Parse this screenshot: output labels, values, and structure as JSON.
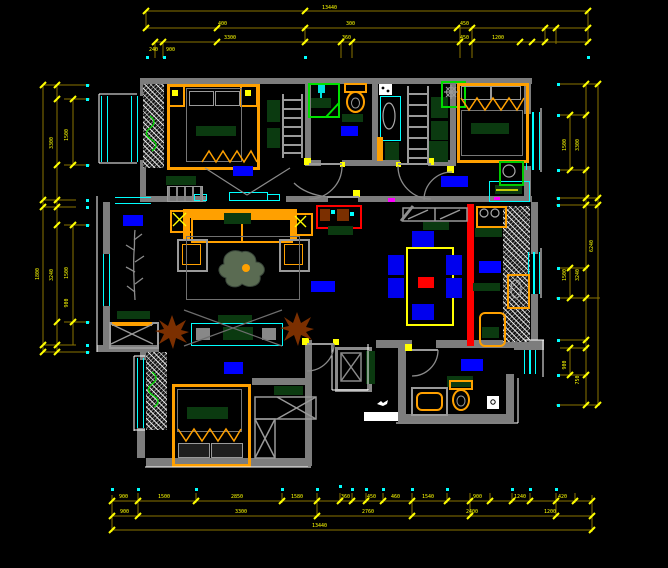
{
  "palette": {
    "background": "#000000",
    "wall_gray": "#7d7d7d",
    "window_cyan": "#00ffff",
    "dimension_line": "#8a7400",
    "dimension_text": "#ffff00",
    "furniture_orange": "#ffa000",
    "soft_green": "#0b3a10",
    "accent_red": "#ff0000",
    "plant_green": "#00dd00",
    "plant_brown": "#7b2f00",
    "label_blue": "#0000ff",
    "chair_blue": "#0000ee"
  },
  "room_labels": [
    {
      "name": "bedroom-northwest",
      "x": 233,
      "y": 166,
      "w": 20,
      "h": 10
    },
    {
      "name": "bathroom-main",
      "x": 341,
      "y": 126,
      "w": 17,
      "h": 10
    },
    {
      "name": "bedroom-northeast",
      "x": 441,
      "y": 176,
      "w": 27,
      "h": 11
    },
    {
      "name": "living-room",
      "x": 123,
      "y": 215,
      "w": 20,
      "h": 11
    },
    {
      "name": "hallway",
      "x": 311,
      "y": 281,
      "w": 24,
      "h": 11
    },
    {
      "name": "kitchen",
      "x": 479,
      "y": 261,
      "w": 22,
      "h": 12
    },
    {
      "name": "bedroom-south",
      "x": 224,
      "y": 362,
      "w": 19,
      "h": 12
    },
    {
      "name": "bathroom-second",
      "x": 461,
      "y": 359,
      "w": 22,
      "h": 12
    }
  ],
  "dimensions": {
    "line_color": "#8a7400",
    "tick_color": "#ffff00",
    "dot_color": "#00ffff",
    "text_color": "#ffff00",
    "h_lines": [
      [
        146,
        11,
        588
      ],
      [
        146,
        28,
        588
      ],
      [
        155,
        42,
        588
      ],
      [
        112,
        501,
        592
      ],
      [
        112,
        516,
        592
      ],
      [
        112,
        530,
        592
      ],
      [
        43,
        85,
        90
      ],
      [
        64,
        99,
        90
      ],
      [
        64,
        165,
        90
      ],
      [
        43,
        200,
        76
      ],
      [
        43,
        207,
        76
      ],
      [
        64,
        225,
        90
      ],
      [
        64,
        322,
        90
      ],
      [
        43,
        345,
        76
      ],
      [
        43,
        352,
        90
      ],
      [
        558,
        84,
        600
      ],
      [
        560,
        115,
        588
      ],
      [
        560,
        170,
        588
      ],
      [
        556,
        198,
        600
      ],
      [
        556,
        205,
        600
      ],
      [
        560,
        268,
        588
      ],
      [
        556,
        298,
        600
      ],
      [
        560,
        340,
        588
      ],
      [
        560,
        348,
        588
      ],
      [
        560,
        375,
        588
      ],
      [
        556,
        405,
        600
      ]
    ],
    "v_lines": [
      [
        146,
        11,
        30
      ],
      [
        588,
        11,
        44
      ],
      [
        305,
        26,
        44
      ],
      [
        155,
        42,
        58
      ],
      [
        163,
        42,
        58
      ],
      [
        341,
        42,
        58
      ],
      [
        352,
        42,
        58
      ],
      [
        460,
        26,
        58
      ],
      [
        472,
        26,
        58
      ],
      [
        545,
        26,
        44
      ],
      [
        556,
        26,
        44
      ],
      [
        43,
        85,
        352
      ],
      [
        57,
        85,
        352
      ],
      [
        73,
        99,
        165
      ],
      [
        73,
        225,
        345
      ],
      [
        586,
        84,
        405
      ],
      [
        598,
        84,
        405
      ],
      [
        570,
        115,
        170
      ],
      [
        570,
        268,
        298
      ],
      [
        570,
        348,
        375
      ],
      [
        112,
        495,
        532
      ],
      [
        138,
        493,
        517
      ],
      [
        196,
        493,
        503
      ],
      [
        282,
        493,
        503
      ],
      [
        317,
        493,
        517
      ],
      [
        340,
        493,
        503
      ],
      [
        352,
        493,
        503
      ],
      [
        366,
        493,
        503
      ],
      [
        383,
        493,
        503
      ],
      [
        412,
        493,
        517
      ],
      [
        447,
        493,
        503
      ],
      [
        470,
        493,
        517
      ],
      [
        490,
        493,
        503
      ],
      [
        512,
        493,
        503
      ],
      [
        530,
        493,
        503
      ],
      [
        556,
        493,
        517
      ],
      [
        575,
        493,
        503
      ],
      [
        592,
        495,
        532
      ]
    ],
    "ticks": [
      [
        146,
        11
      ],
      [
        305,
        11
      ],
      [
        588,
        11
      ],
      [
        146,
        28
      ],
      [
        217,
        28
      ],
      [
        305,
        28
      ],
      [
        457,
        28
      ],
      [
        472,
        28
      ],
      [
        545,
        28
      ],
      [
        556,
        28
      ],
      [
        588,
        28
      ],
      [
        155,
        42
      ],
      [
        163,
        42
      ],
      [
        217,
        42
      ],
      [
        305,
        42
      ],
      [
        341,
        42
      ],
      [
        352,
        42
      ],
      [
        460,
        42
      ],
      [
        472,
        42
      ],
      [
        520,
        42
      ],
      [
        532,
        42
      ],
      [
        545,
        42
      ],
      [
        588,
        42
      ],
      [
        43,
        85
      ],
      [
        57,
        85
      ],
      [
        73,
        99
      ],
      [
        57,
        99
      ],
      [
        73,
        165
      ],
      [
        57,
        165
      ],
      [
        43,
        200
      ],
      [
        57,
        200
      ],
      [
        43,
        207
      ],
      [
        57,
        207
      ],
      [
        73,
        225
      ],
      [
        57,
        225
      ],
      [
        73,
        322
      ],
      [
        57,
        322
      ],
      [
        43,
        345
      ],
      [
        57,
        345
      ],
      [
        43,
        352
      ],
      [
        57,
        352
      ],
      [
        586,
        84
      ],
      [
        598,
        84
      ],
      [
        570,
        115
      ],
      [
        586,
        115
      ],
      [
        570,
        170
      ],
      [
        586,
        170
      ],
      [
        586,
        198
      ],
      [
        598,
        198
      ],
      [
        586,
        205
      ],
      [
        598,
        205
      ],
      [
        570,
        268
      ],
      [
        586,
        268
      ],
      [
        570,
        298
      ],
      [
        586,
        298
      ],
      [
        586,
        340
      ],
      [
        586,
        348
      ],
      [
        570,
        348
      ],
      [
        570,
        375
      ],
      [
        586,
        375
      ],
      [
        586,
        405
      ],
      [
        598,
        405
      ],
      [
        112,
        501
      ],
      [
        138,
        501
      ],
      [
        196,
        501
      ],
      [
        282,
        501
      ],
      [
        317,
        501
      ],
      [
        340,
        501
      ],
      [
        352,
        501
      ],
      [
        366,
        501
      ],
      [
        383,
        501
      ],
      [
        412,
        501
      ],
      [
        447,
        501
      ],
      [
        470,
        501
      ],
      [
        490,
        501
      ],
      [
        512,
        501
      ],
      [
        530,
        501
      ],
      [
        556,
        501
      ],
      [
        575,
        501
      ],
      [
        592,
        501
      ],
      [
        112,
        516
      ],
      [
        138,
        516
      ],
      [
        317,
        516
      ],
      [
        412,
        516
      ],
      [
        470,
        516
      ],
      [
        556,
        516
      ],
      [
        592,
        516
      ],
      [
        112,
        530
      ],
      [
        592,
        530
      ]
    ],
    "dots": [
      [
        87,
        85
      ],
      [
        87,
        99
      ],
      [
        87,
        165
      ],
      [
        87,
        200
      ],
      [
        87,
        207
      ],
      [
        87,
        225
      ],
      [
        87,
        322
      ],
      [
        87,
        345
      ],
      [
        87,
        352
      ],
      [
        558,
        84
      ],
      [
        558,
        115
      ],
      [
        558,
        170
      ],
      [
        558,
        198
      ],
      [
        558,
        205
      ],
      [
        558,
        268
      ],
      [
        558,
        298
      ],
      [
        558,
        340
      ],
      [
        558,
        375
      ],
      [
        558,
        405
      ],
      [
        112,
        489
      ],
      [
        138,
        489
      ],
      [
        196,
        489
      ],
      [
        282,
        489
      ],
      [
        317,
        489
      ],
      [
        340,
        486
      ],
      [
        352,
        489
      ],
      [
        366,
        489
      ],
      [
        383,
        489
      ],
      [
        412,
        489
      ],
      [
        447,
        489
      ],
      [
        512,
        489
      ],
      [
        530,
        489
      ],
      [
        556,
        489
      ],
      [
        147,
        57
      ],
      [
        164,
        57
      ],
      [
        305,
        57
      ],
      [
        588,
        57
      ]
    ],
    "labels": [
      {
        "t": "13440",
        "x": 322,
        "y": 5
      },
      {
        "t": "400",
        "x": 218,
        "y": 21
      },
      {
        "t": "300",
        "x": 346,
        "y": 21
      },
      {
        "t": "450",
        "x": 460,
        "y": 21
      },
      {
        "t": "3300",
        "x": 224,
        "y": 35
      },
      {
        "t": "360",
        "x": 342,
        "y": 35
      },
      {
        "t": "450",
        "x": 460,
        "y": 35
      },
      {
        "t": "1200",
        "x": 492,
        "y": 35
      },
      {
        "t": "240",
        "x": 149,
        "y": 47
      },
      {
        "t": "900",
        "x": 166,
        "y": 47
      },
      {
        "t": "1500",
        "x": 66,
        "y": 132,
        "rot": 1
      },
      {
        "t": "3300",
        "x": 51,
        "y": 140,
        "rot": 1
      },
      {
        "t": "1500",
        "x": 66,
        "y": 270,
        "rot": 1
      },
      {
        "t": "900",
        "x": 66,
        "y": 300,
        "rot": 1
      },
      {
        "t": "3240",
        "x": 51,
        "y": 272,
        "rot": 1
      },
      {
        "t": "1800",
        "x": 37,
        "y": 271,
        "rot": 1
      },
      {
        "t": "1500",
        "x": 564,
        "y": 142,
        "rot": 1
      },
      {
        "t": "3300",
        "x": 577,
        "y": 142,
        "rot": 1
      },
      {
        "t": "6240",
        "x": 591,
        "y": 243,
        "rot": 1
      },
      {
        "t": "1500",
        "x": 564,
        "y": 272,
        "rot": 1
      },
      {
        "t": "3240",
        "x": 577,
        "y": 272,
        "rot": 1
      },
      {
        "t": "900",
        "x": 564,
        "y": 362,
        "rot": 1
      },
      {
        "t": "750",
        "x": 577,
        "y": 377,
        "rot": 1
      },
      {
        "t": "900",
        "x": 119,
        "y": 494
      },
      {
        "t": "1500",
        "x": 158,
        "y": 494
      },
      {
        "t": "2850",
        "x": 231,
        "y": 494
      },
      {
        "t": "1580",
        "x": 291,
        "y": 494
      },
      {
        "t": "360",
        "x": 341,
        "y": 494
      },
      {
        "t": "450",
        "x": 367,
        "y": 494
      },
      {
        "t": "460",
        "x": 391,
        "y": 494
      },
      {
        "t": "1540",
        "x": 422,
        "y": 494
      },
      {
        "t": "900",
        "x": 473,
        "y": 494
      },
      {
        "t": "1240",
        "x": 514,
        "y": 494
      },
      {
        "t": "420",
        "x": 558,
        "y": 494
      },
      {
        "t": "900",
        "x": 120,
        "y": 509
      },
      {
        "t": "3300",
        "x": 235,
        "y": 509
      },
      {
        "t": "2760",
        "x": 362,
        "y": 509
      },
      {
        "t": "2400",
        "x": 466,
        "y": 509
      },
      {
        "t": "1200",
        "x": 544,
        "y": 509
      },
      {
        "t": "13440",
        "x": 312,
        "y": 523
      }
    ]
  }
}
